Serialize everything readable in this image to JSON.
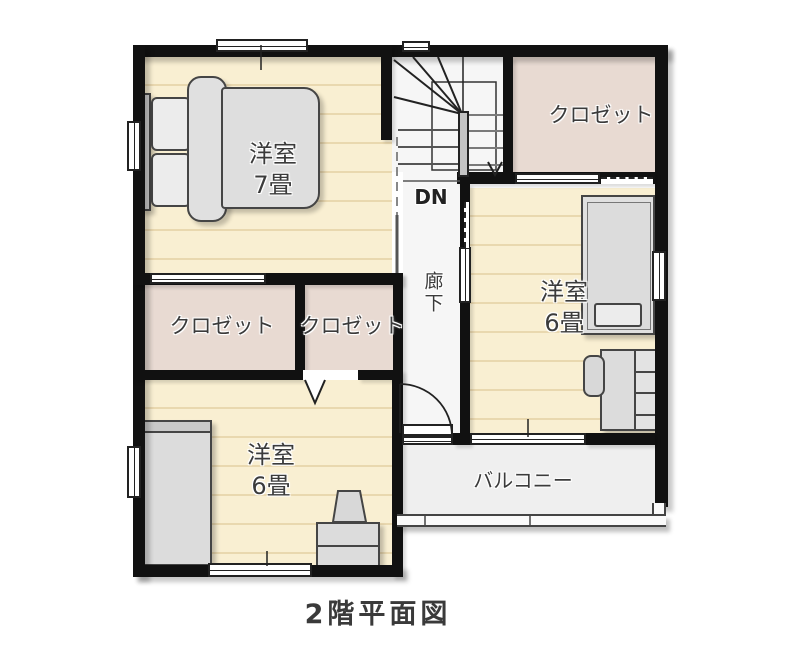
{
  "title": "2階平面図",
  "labels": {
    "bedroom7_name": "洋室",
    "bedroom7_size": "7畳",
    "bedroom6_right_name": "洋室",
    "bedroom6_right_size": "6畳",
    "bedroom6_bottom_name": "洋室",
    "bedroom6_bottom_size": "6畳",
    "closet_top_right": "クロゼット",
    "closet_mid_left": "クロゼット",
    "closet_mid_right": "クロゼット",
    "hallway": "廊下",
    "stairs_down": "DN",
    "balcony": "バルコニー"
  },
  "colors": {
    "floor_wood": "#f9efd2",
    "floor_stripe": "#e7d3a6",
    "closet_pink": "#e8dad2",
    "corridor_white": "#f6f6f6",
    "balcony_gray": "#efefef",
    "wall_black": "#111111",
    "furniture_gray": "#dcdcdc",
    "furniture_outline": "#454545",
    "label_text": "#3b3b3b"
  }
}
